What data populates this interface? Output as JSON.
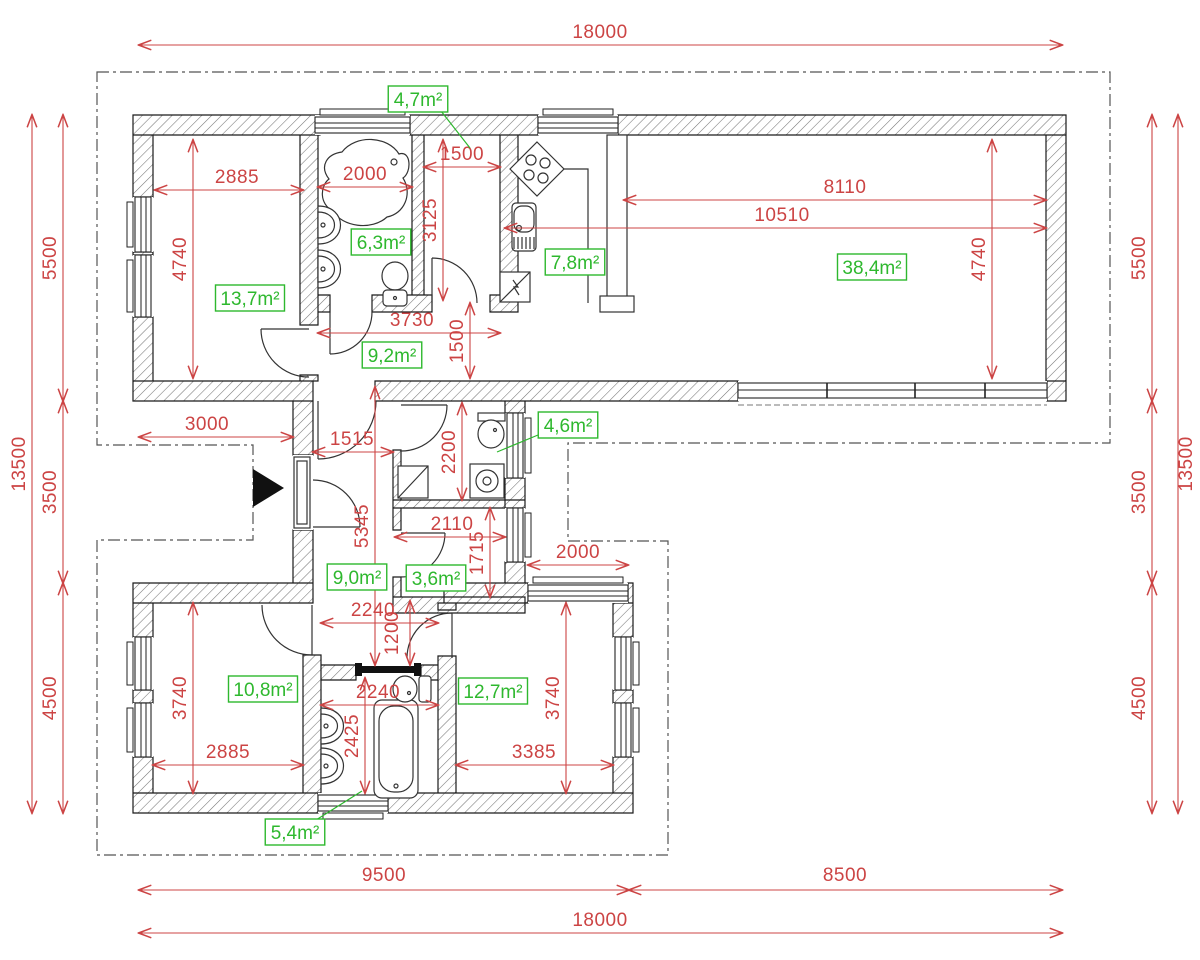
{
  "drawing": {
    "type": "architectural floor plan",
    "overall_width_label": "18000",
    "overall_height_label": "13500"
  },
  "colors": {
    "dimension": "#cc4444",
    "room_label": "#2eb82e",
    "wall_outline": "#1a1a1a",
    "site_boundary": "#555555",
    "entrance_marker": "#111111",
    "background": "#ffffff"
  },
  "dimensions": [
    {
      "label": "18000",
      "x1": 139,
      "y1": 45,
      "x2": 1062,
      "y2": 45,
      "tx": 600,
      "ty": 38,
      "vertical": false
    },
    {
      "label": "2885",
      "x1": 155,
      "y1": 190,
      "x2": 303,
      "y2": 190,
      "tx": 237,
      "ty": 183,
      "vertical": false
    },
    {
      "label": "2000",
      "x1": 318,
      "y1": 187,
      "x2": 412,
      "y2": 187,
      "tx": 365,
      "ty": 180,
      "vertical": false
    },
    {
      "label": "1500",
      "x1": 424,
      "y1": 167,
      "x2": 500,
      "y2": 167,
      "tx": 462,
      "ty": 160,
      "vertical": false
    },
    {
      "label": "8110",
      "x1": 624,
      "y1": 200,
      "x2": 1046,
      "y2": 200,
      "tx": 845,
      "ty": 193,
      "vertical": false
    },
    {
      "label": "10510",
      "x1": 505,
      "y1": 228,
      "x2": 1046,
      "y2": 228,
      "tx": 782,
      "ty": 221,
      "vertical": false
    },
    {
      "label": "3730",
      "x1": 318,
      "y1": 333,
      "x2": 500,
      "y2": 333,
      "tx": 412,
      "ty": 326,
      "vertical": false
    },
    {
      "label": "3000",
      "x1": 139,
      "y1": 437,
      "x2": 293,
      "y2": 437,
      "tx": 207,
      "ty": 430,
      "vertical": false
    },
    {
      "label": "1515",
      "x1": 313,
      "y1": 452,
      "x2": 393,
      "y2": 452,
      "tx": 352,
      "ty": 445,
      "vertical": false
    },
    {
      "label": "2110",
      "x1": 395,
      "y1": 537,
      "x2": 505,
      "y2": 537,
      "tx": 452,
      "ty": 530,
      "vertical": false
    },
    {
      "label": "2000",
      "x1": 528,
      "y1": 565,
      "x2": 628,
      "y2": 565,
      "tx": 578,
      "ty": 558,
      "vertical": false
    },
    {
      "label": "2240",
      "x1": 321,
      "y1": 623,
      "x2": 438,
      "y2": 623,
      "tx": 373,
      "ty": 616,
      "vertical": false
    },
    {
      "label": "2240",
      "x1": 321,
      "y1": 705,
      "x2": 438,
      "y2": 705,
      "tx": 378,
      "ty": 698,
      "vertical": false
    },
    {
      "label": "2885",
      "x1": 153,
      "y1": 765,
      "x2": 303,
      "y2": 765,
      "tx": 228,
      "ty": 758,
      "vertical": false
    },
    {
      "label": "3385",
      "x1": 456,
      "y1": 765,
      "x2": 613,
      "y2": 765,
      "tx": 534,
      "ty": 758,
      "vertical": false
    },
    {
      "label": "9500",
      "x1": 139,
      "y1": 890,
      "x2": 629,
      "y2": 890,
      "tx": 384,
      "ty": 881,
      "vertical": false
    },
    {
      "label": "8500",
      "x1": 629,
      "y1": 890,
      "x2": 1062,
      "y2": 890,
      "tx": 845,
      "ty": 881,
      "vertical": false
    },
    {
      "label": "18000",
      "x1": 139,
      "y1": 933,
      "x2": 1062,
      "y2": 933,
      "tx": 600,
      "ty": 926,
      "vertical": false
    },
    {
      "label": "13500",
      "x1": 32,
      "y1": 115,
      "x2": 32,
      "y2": 813,
      "tx": 25,
      "ty": 464,
      "vertical": true
    },
    {
      "label": "5500",
      "x1": 63,
      "y1": 115,
      "x2": 63,
      "y2": 401,
      "tx": 56,
      "ty": 258,
      "vertical": true
    },
    {
      "label": "3500",
      "x1": 63,
      "y1": 401,
      "x2": 63,
      "y2": 583,
      "tx": 56,
      "ty": 492,
      "vertical": true
    },
    {
      "label": "4500",
      "x1": 63,
      "y1": 583,
      "x2": 63,
      "y2": 813,
      "tx": 56,
      "ty": 698,
      "vertical": true
    },
    {
      "label": "4740",
      "x1": 193,
      "y1": 140,
      "x2": 193,
      "y2": 378,
      "tx": 186,
      "ty": 259,
      "vertical": true
    },
    {
      "label": "3125",
      "x1": 443,
      "y1": 140,
      "x2": 443,
      "y2": 300,
      "tx": 436,
      "ty": 220,
      "vertical": true
    },
    {
      "label": "4740",
      "x1": 992,
      "y1": 140,
      "x2": 992,
      "y2": 378,
      "tx": 985,
      "ty": 259,
      "vertical": true
    },
    {
      "label": "1500",
      "x1": 470,
      "y1": 303,
      "x2": 470,
      "y2": 378,
      "tx": 463,
      "ty": 341,
      "vertical": true
    },
    {
      "label": "5345",
      "x1": 375,
      "y1": 387,
      "x2": 375,
      "y2": 665,
      "tx": 368,
      "ty": 526,
      "vertical": true
    },
    {
      "label": "2200",
      "x1": 462,
      "y1": 403,
      "x2": 462,
      "y2": 500,
      "tx": 455,
      "ty": 452,
      "vertical": true
    },
    {
      "label": "1715",
      "x1": 490,
      "y1": 508,
      "x2": 490,
      "y2": 597,
      "tx": 483,
      "ty": 553,
      "vertical": true
    },
    {
      "label": "1200",
      "x1": 410,
      "y1": 601,
      "x2": 410,
      "y2": 665,
      "tx": 398,
      "ty": 633,
      "vertical": true
    },
    {
      "label": "2425",
      "x1": 365,
      "y1": 678,
      "x2": 365,
      "y2": 793,
      "tx": 358,
      "ty": 736,
      "vertical": true
    },
    {
      "label": "3740",
      "x1": 193,
      "y1": 603,
      "x2": 193,
      "y2": 793,
      "tx": 186,
      "ty": 698,
      "vertical": true
    },
    {
      "label": "3740",
      "x1": 566,
      "y1": 603,
      "x2": 566,
      "y2": 793,
      "tx": 559,
      "ty": 698,
      "vertical": true
    },
    {
      "label": "13500",
      "x1": 1178,
      "y1": 115,
      "x2": 1178,
      "y2": 813,
      "tx": 1192,
      "ty": 464,
      "vertical": true
    },
    {
      "label": "5500",
      "x1": 1152,
      "y1": 115,
      "x2": 1152,
      "y2": 401,
      "tx": 1145,
      "ty": 258,
      "vertical": true
    },
    {
      "label": "3500",
      "x1": 1152,
      "y1": 401,
      "x2": 1152,
      "y2": 583,
      "tx": 1145,
      "ty": 492,
      "vertical": true
    },
    {
      "label": "4500",
      "x1": 1152,
      "y1": 583,
      "x2": 1152,
      "y2": 813,
      "tx": 1145,
      "ty": 698,
      "vertical": true
    }
  ],
  "room_areas": [
    {
      "label": "4,7m²",
      "cx": 418,
      "cy": 99,
      "leader": [
        441,
        111,
        470,
        148
      ]
    },
    {
      "label": "6,3m²",
      "cx": 381,
      "cy": 242
    },
    {
      "label": "7,8m²",
      "cx": 575,
      "cy": 262
    },
    {
      "label": "38,4m²",
      "cx": 872,
      "cy": 267
    },
    {
      "label": "13,7m²",
      "cx": 250,
      "cy": 298
    },
    {
      "label": "9,2m²",
      "cx": 392,
      "cy": 355
    },
    {
      "label": "4,6m²",
      "cx": 568,
      "cy": 425,
      "leader": [
        538,
        435,
        497,
        452
      ]
    },
    {
      "label": "9,0m²",
      "cx": 357,
      "cy": 577
    },
    {
      "label": "3,6m²",
      "cx": 436,
      "cy": 578
    },
    {
      "label": "10,8m²",
      "cx": 263,
      "cy": 689
    },
    {
      "label": "12,7m²",
      "cx": 493,
      "cy": 691
    },
    {
      "label": "5,4m²",
      "cx": 295,
      "cy": 832,
      "leader": [
        316,
        820,
        362,
        791
      ]
    }
  ]
}
